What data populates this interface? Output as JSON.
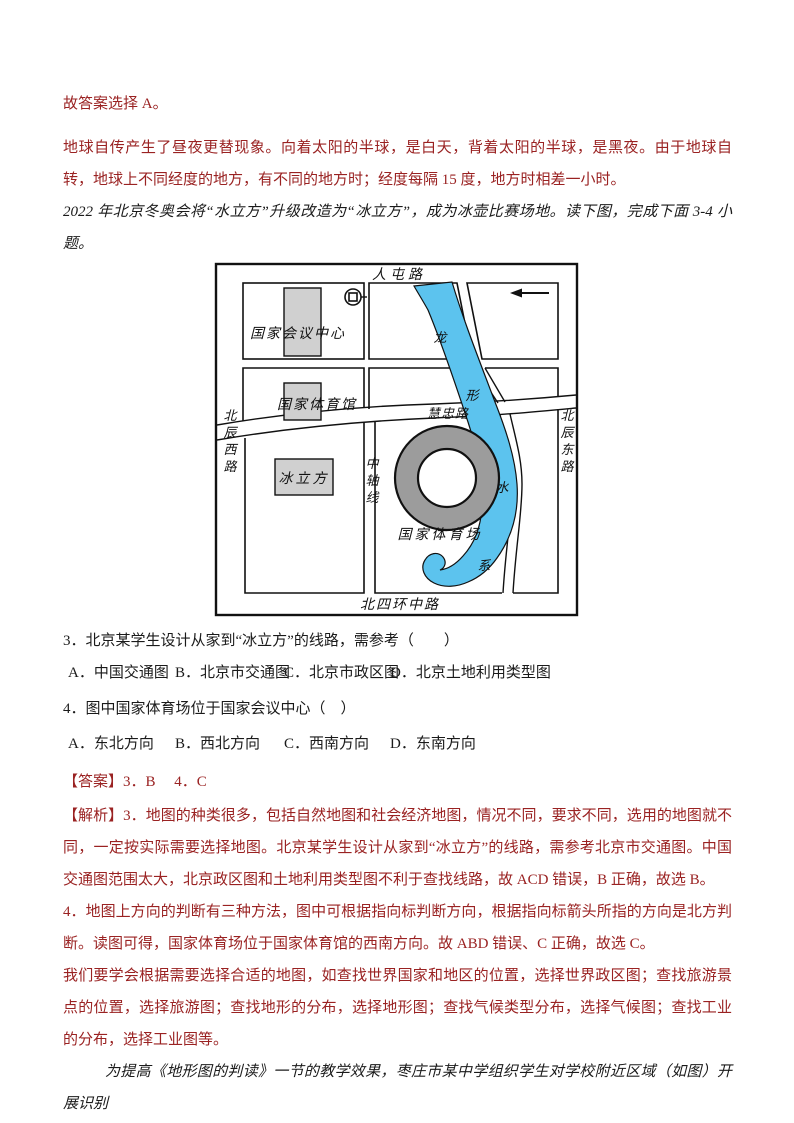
{
  "colors": {
    "red_text": "#9a2222",
    "ink": "#1a1a1a",
    "river": "#5cc3ee",
    "building_fill": "#d0d0d0",
    "ring_fill": "#9c9c9c"
  },
  "paragraphs": {
    "answer_note": "故答案选择 A。",
    "rotation_explanation": "地球自传产生了昼夜更替现象。向着太阳的半球，是白天，背着太阳的半球，是黑夜。由于地球自转，地球上不同经度的地方，有不同的地方时；经度每隔 15 度，地方时相差一小时。",
    "intro": "2022 年北京冬奥会将“水立方”升级改造为“冰立方”，成为冰壶比赛场地。读下图，完成下面 3-4 小题。",
    "answer_line": "【答案】3．B　 4．C",
    "analysis_1": "【解析】3．地图的种类很多，包括自然地图和社会经济地图，情况不同，要求不同，选用的地图就不同，一定按实际需要选择地图。北京某学生设计从家到“冰立方”的线路，需参考北京市交通图。中国交通图范围太大，北京政区图和土地利用类型图不利于查找线路，故 ACD 错误，B 正确，故选 B。",
    "analysis_2": "4．地图上方向的判断有三种方法，图中可根据指向标判断方向，根据指向标箭头所指的方向是北方判断。读图可得，国家体育场位于国家体育馆的西南方向。故 ABD 错误、C 正确，故选 C。",
    "analysis_3": "我们要学会根据需要选择合适的地图，如查找世界国家和地区的位置，选择世界政区图；查找旅游景点的位置，选择旅游图；查找地形的分布，选择地形图；查找气候类型分布，选择气候图；查找工业的分布，选择工业图等。",
    "footer_intro": "为提高《地形图的判读》一节的教学效果，枣庄市某中学组织学生对学校附近区域（如图）开展识别"
  },
  "questions": [
    {
      "text": "3．北京某学生设计从家到“冰立方”的线路，需参考（　　）",
      "options": [
        "A．中国交通图",
        "B．北京市交通图",
        "C．北京市政区图",
        "D．北京土地利用类型图"
      ]
    },
    {
      "text": "4．图中国家体育场位于国家会议中心（　）",
      "options": [
        "A．东北方向",
        "B．西北方向",
        "C．西南方向",
        "D．东南方向"
      ]
    }
  ],
  "map": {
    "labels": [
      {
        "name": "road-label-rentun",
        "text": "人屯路",
        "x": 185,
        "y": 17,
        "size": 14,
        "spacing": 4
      },
      {
        "name": "road-label-beisihuanzhong",
        "text": "北四环中路",
        "x": 186,
        "y": 347,
        "size": 14,
        "spacing": 2
      },
      {
        "name": "road-label-beichen-west",
        "text": "北辰西路",
        "x": 16,
        "y": 158,
        "size": 13,
        "vertical": true,
        "dy": 17
      },
      {
        "name": "road-label-beichen-east",
        "text": "北辰东路",
        "x": 353,
        "y": 158,
        "size": 13,
        "vertical": true,
        "dy": 17
      },
      {
        "name": "road-label-zhongzhouxian",
        "text": "中轴线",
        "x": 158,
        "y": 206,
        "size": 13,
        "vertical": true,
        "dy": 17
      },
      {
        "name": "road-label-huizhong",
        "text": "慧忠路",
        "x": 234,
        "y": 156,
        "size": 13,
        "spacing": 1
      },
      {
        "name": "place-label-convention-center",
        "text": "国家会议中心",
        "x": 84,
        "y": 76,
        "size": 14,
        "spacing": 2
      },
      {
        "name": "place-label-gymnasium",
        "text": "国家体育馆",
        "x": 103,
        "y": 147,
        "size": 14,
        "spacing": 2
      },
      {
        "name": "place-label-ice-cube",
        "text": "冰立方",
        "x": 90,
        "y": 221,
        "size": 14,
        "spacing": 3
      },
      {
        "name": "place-label-national-stadium",
        "text": "国家体育场",
        "x": 226,
        "y": 277,
        "size": 14,
        "spacing": 3
      },
      {
        "name": "river-char-long",
        "text": "龙",
        "x": 226,
        "y": 80,
        "size": 13
      },
      {
        "name": "river-char-xing",
        "text": "形",
        "x": 258,
        "y": 138,
        "size": 13
      },
      {
        "name": "river-char-shui",
        "text": "水",
        "x": 288,
        "y": 230,
        "size": 13
      },
      {
        "name": "river-char-xi",
        "text": "系",
        "x": 270,
        "y": 308,
        "size": 13
      }
    ]
  }
}
